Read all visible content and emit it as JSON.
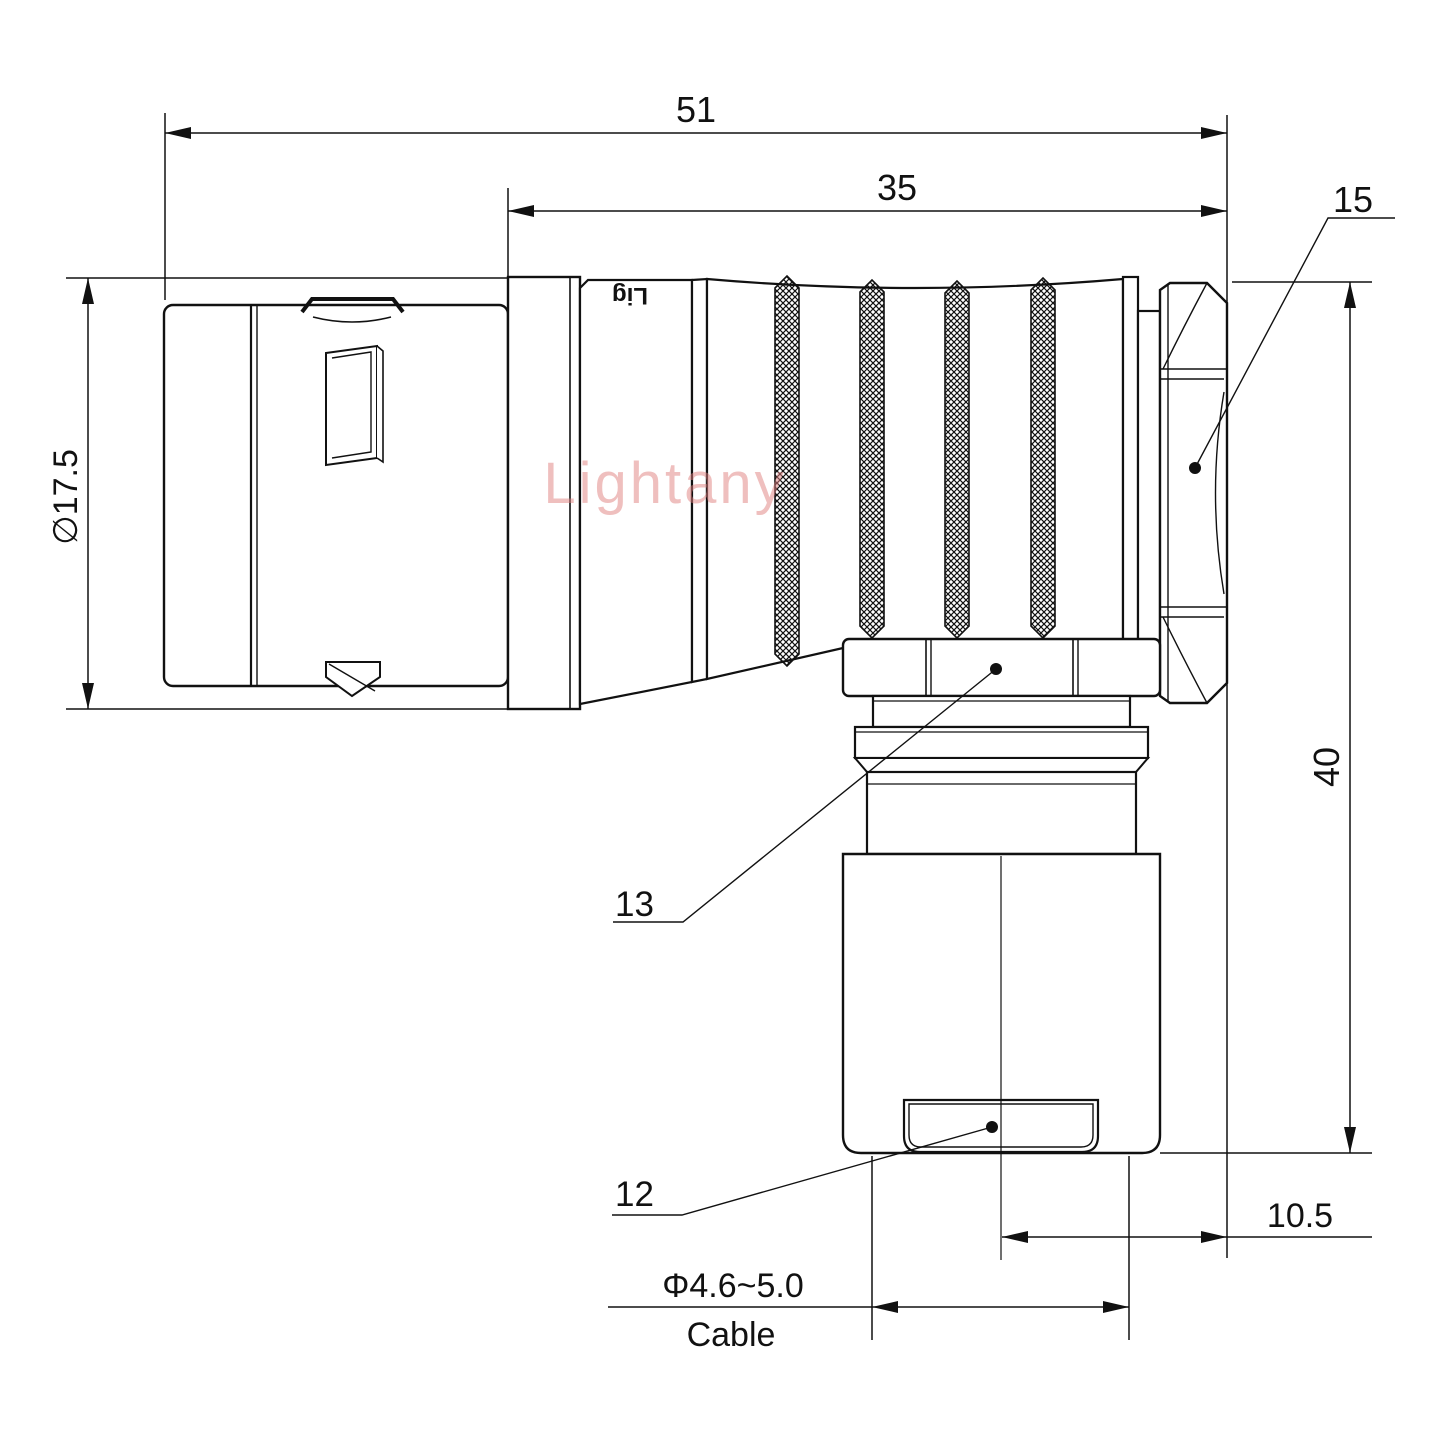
{
  "drawing": {
    "watermark": "Lightany",
    "engraving": "Lig",
    "dimensions": {
      "overall_length": "51",
      "body_length": "35",
      "front_diameter": "∅17.5",
      "height": "40",
      "axis_offset": "10.5",
      "cable_diameter": "Φ4.6~5.0",
      "cable_label": "Cable"
    },
    "part_labels": {
      "back_nut": "15",
      "coupling_nut": "13",
      "cable_cap": "12"
    }
  }
}
